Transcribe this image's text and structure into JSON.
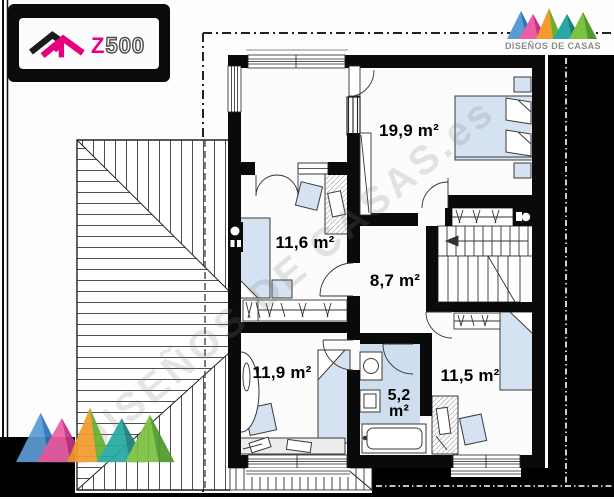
{
  "branding": {
    "z500": {
      "z": "Z",
      "rest": "500"
    },
    "disenos": {
      "name": "DISEÑOS DE CASAS"
    }
  },
  "watermark": {
    "text": "DISEÑOS DE CASAS.es"
  },
  "floor_plan": {
    "rooms": [
      {
        "id": "bedroom-main",
        "area": "19,9 m²"
      },
      {
        "id": "bedroom-2",
        "area": "11,6 m²"
      },
      {
        "id": "hallway",
        "area": "8,7 m²"
      },
      {
        "id": "bedroom-3",
        "area": "11,9 m²"
      },
      {
        "id": "bathroom",
        "area_value": "5,2",
        "area_unit": "m²"
      },
      {
        "id": "bedroom-4",
        "area": "11,5 m²"
      }
    ],
    "colors": {
      "wall": "#0a0a0a",
      "furniture_fill": "#d4e2f2",
      "accent_magenta": "#e6007e"
    }
  }
}
